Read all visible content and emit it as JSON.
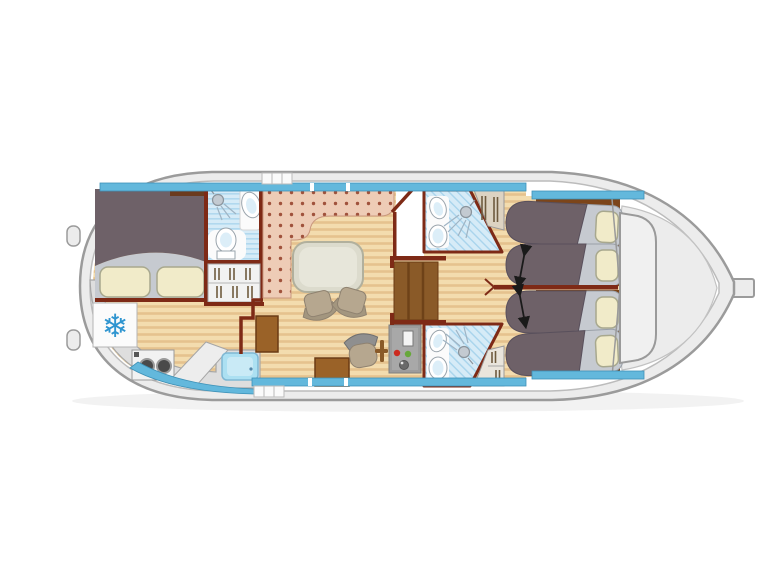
{
  "plan": {
    "type": "boat-floor-plan-top-view",
    "areas": [
      "aft-cabin-double-bed",
      "aft-bathroom",
      "wardrobe",
      "saloon-settee",
      "saloon-table",
      "galley",
      "helm-station",
      "companionway-stairs",
      "fore-bathroom-top",
      "fore-bathroom-bottom",
      "fore-cabin-top",
      "fore-cabin-bottom",
      "foredeck"
    ],
    "berths": {
      "double_beds": 1,
      "single_beds": 4
    },
    "bathrooms": 3,
    "icons": {
      "freezer": "❄",
      "slide_arrow": "double-headed-arrow",
      "shower": "shower-head-with-spray",
      "burners": "two-ring-hob"
    }
  },
  "colors": {
    "hull_ring": "#ececec",
    "hull_stroke": "#9b9b9b",
    "deck": "#ffffff",
    "deck_stroke": "#bcbcbc",
    "trim_blue": "#63b8dc",
    "trim_stroke": "#3e92b8",
    "wood_base": "#f3dcae",
    "wood_stripe": "#e5c28e",
    "carpet_base": "#eeccb6",
    "carpet_dot": "#a0523c",
    "tile_base": "#d6ebf7",
    "tile_stripe": "#a8d4ec",
    "wall": "#7e2a16",
    "blanket": "#6e6168",
    "mattress": "#c6cad0",
    "pillow": "#f1ebc9",
    "pillow_stroke": "#a8a88e",
    "bed_base": "#7c451a",
    "stairs": "#8a5a28",
    "stairs_dark": "#6e4218",
    "cabinet": "#9a6228",
    "cabinet_stroke": "#6b3b14",
    "table": "#dcdbcd",
    "table_stroke": "#b1b09d",
    "table_top": "#e7e6da",
    "chair_seat": "#b6a78f",
    "chair_back": "#a3967f",
    "chair_stroke": "#8f8270",
    "counter": "#dedede",
    "counter_stroke": "#a6a6a6",
    "slab": "#ededed",
    "sink": "#ace0f2",
    "sink_inner": "#c9eaf6",
    "sink_stroke": "#7fb8d4",
    "appliance": "#f2f2f2",
    "burner": "#4a4a4a",
    "console": "#9c9c9c",
    "console_face": "#a8a8a8",
    "screen": "#f4f4f4",
    "red_dot": "#cc2a1f",
    "green_dot": "#67a83a",
    "snowflake": "#2f95d0",
    "fixture": "#ffffff",
    "fixture_stroke": "#9aa4ac",
    "basin": "#dceef8",
    "shower": "#c3cad1",
    "shower_stroke": "#8b949c",
    "spray": "#9fb4c4",
    "locker": "#ddd3c2",
    "locker_light": "#e9e5dc",
    "hanger": "#6f5b3e",
    "glass": "#f0f0f0",
    "frame": "#9a9a9a",
    "foredeck": "#ececec",
    "arrow": "#1a1a1a",
    "white_patch": "#fbfbfb",
    "dark_shelf": "#6b3b1e",
    "steps": "#fafafa"
  }
}
